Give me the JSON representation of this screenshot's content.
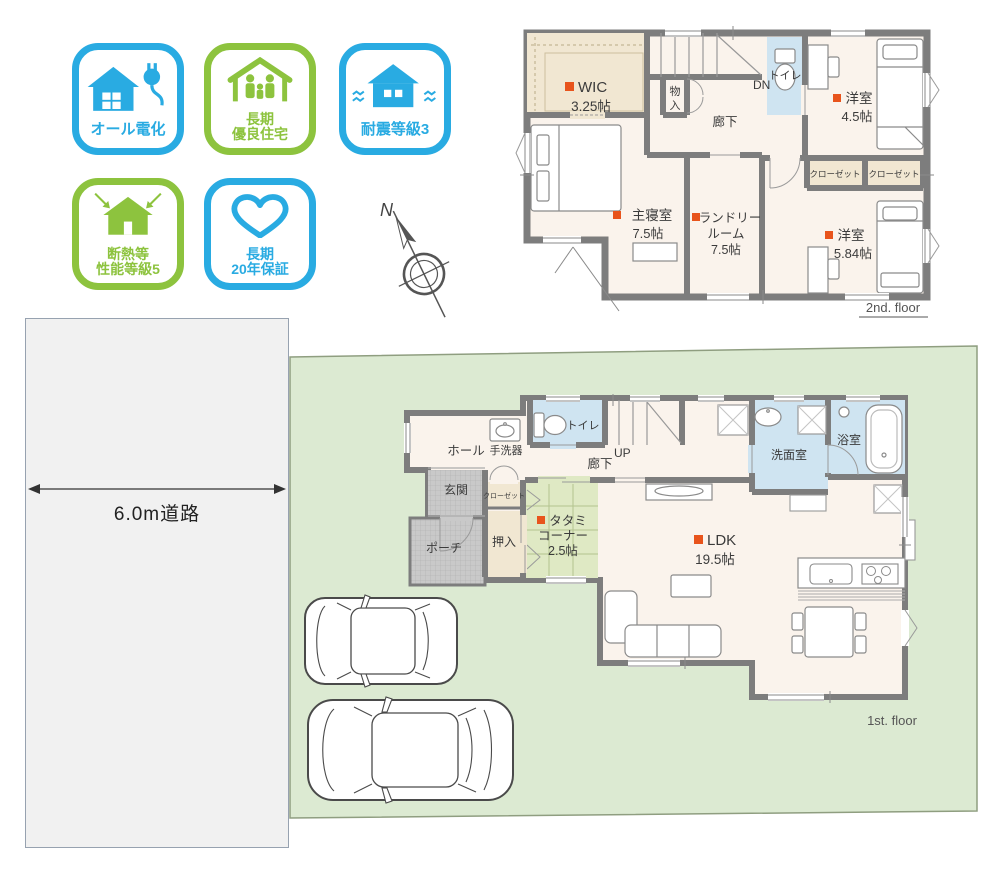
{
  "colors": {
    "badge_blue": "#29abe2",
    "badge_green": "#8dc33e",
    "bullet_orange": "#e8541c",
    "lot_green": "#dcead2",
    "tatami_green": "#dfe9c4",
    "wet_room_blue": "#cfe4f1",
    "closet_beige": "#f1e7d2",
    "floor_cream": "#faf3ec",
    "wall_gray": "#7d7d7d"
  },
  "badges": [
    {
      "name": "all-electric",
      "color": "#29abe2",
      "lines": [
        "オール電化"
      ]
    },
    {
      "name": "long-term-quality-housing",
      "color": "#8dc33e",
      "lines": [
        "長期",
        "優良住宅"
      ]
    },
    {
      "name": "seismic-grade-3",
      "color": "#29abe2",
      "lines": [
        "耐震等級3"
      ]
    },
    {
      "name": "insulation-performance-grade-5",
      "color": "#8dc33e",
      "lines": [
        "断熱等",
        "性能等級5"
      ]
    },
    {
      "name": "long-term-20-year-warranty",
      "color": "#29abe2",
      "lines": [
        "長期",
        "20年保証"
      ]
    }
  ],
  "compass": {
    "north_label": "N"
  },
  "road": {
    "label": "6.0m道路"
  },
  "floor2": {
    "caption": "2nd. floor",
    "wic": {
      "name": "WIC",
      "size": "3.25帖"
    },
    "storage_char1": "物",
    "storage_char2": "入",
    "stairs_label": "DN",
    "toilet": "トイレ",
    "hallway": "廊下",
    "bedroom_45": {
      "name": "洋室",
      "size": "4.5帖"
    },
    "closet_left": "クローゼット",
    "closet_right": "クローゼット",
    "master": {
      "name": "主寝室",
      "size": "7.5帖"
    },
    "laundry": {
      "line1": "ランドリー",
      "line2": "ルーム",
      "size": "7.5帖"
    },
    "bedroom_584": {
      "name": "洋室",
      "size": "5.84帖"
    }
  },
  "floor1": {
    "caption": "1st. floor",
    "hall": "ホール",
    "hand_basin": "手洗器",
    "toilet": "トイレ",
    "stairs_label": "UP",
    "hallway": "廊下",
    "entrance": "玄関",
    "porch": "ポーチ",
    "closet": "クローゼット",
    "oshiire": "押入",
    "tatami": {
      "line1": "タタミ",
      "line2": "コーナー",
      "size": "2.5帖"
    },
    "ldk": {
      "name": "LDK",
      "size": "19.5帖"
    },
    "washroom": "洗面室",
    "bathroom": "浴室"
  }
}
